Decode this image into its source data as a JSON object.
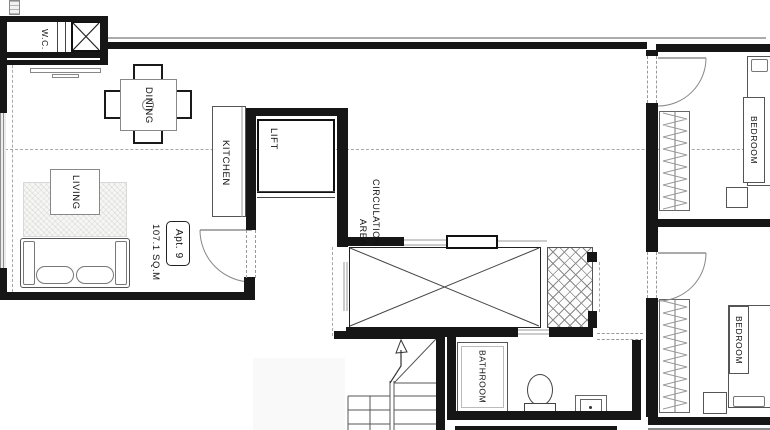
{
  "apartment": {
    "unit": "Apt. 9",
    "area": "107.1 SQ.M"
  },
  "rooms": {
    "wc": "W.C.",
    "dining": "DINING",
    "living": "LIVING",
    "kitchen": "KITCHEN",
    "lift": "LIFT",
    "circulation": "CIRCULATION AREA",
    "bathroom": "BATHROOM",
    "bedroom_top": "BEDROOM",
    "bedroom_bottom": "BEDROOM"
  },
  "colors": {
    "wall": "#161616",
    "line": "#666666",
    "dash": "#a8a8a8",
    "paper": "#ffffff",
    "ink": "#111111"
  }
}
